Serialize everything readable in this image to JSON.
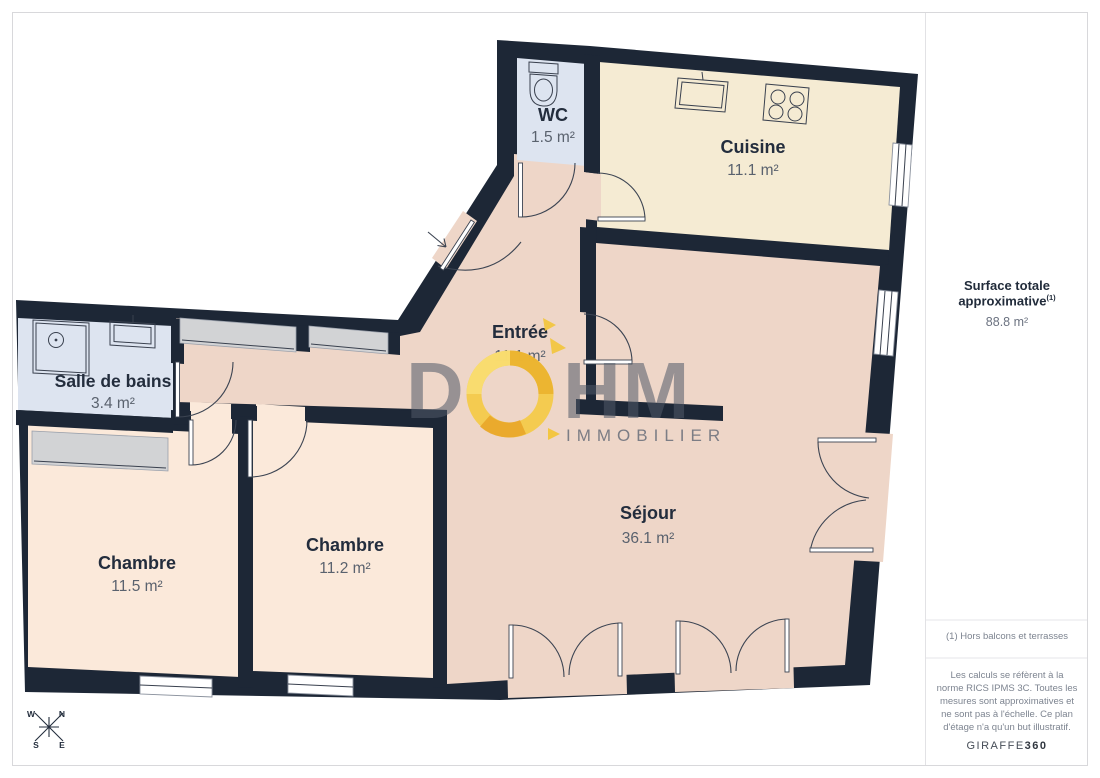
{
  "plan": {
    "rooms": [
      {
        "id": "wc",
        "name": "WC",
        "area": "1.5 m²"
      },
      {
        "id": "cuisine",
        "name": "Cuisine",
        "area": "11.1 m²"
      },
      {
        "id": "entree",
        "name": "Entrée",
        "area": "11.1 m²"
      },
      {
        "id": "salle-de-bains",
        "name": "Salle de bains",
        "area": "3.4 m²"
      },
      {
        "id": "chambre-1",
        "name": "Chambre",
        "area": "11.5 m²"
      },
      {
        "id": "chambre-2",
        "name": "Chambre",
        "area": "11.2 m²"
      },
      {
        "id": "sejour",
        "name": "Séjour",
        "area": "36.1 m²"
      }
    ],
    "compass": {
      "n": "N",
      "e": "E",
      "s": "S",
      "w": "W"
    }
  },
  "watermark": {
    "d": "D",
    "hm": "HM",
    "tagline": "IMMOBILIER"
  },
  "sidebar": {
    "surface_label": "Surface totale approximative",
    "surface_footnote_ref": "(1)",
    "surface_value": "88.8 m²",
    "footnote": "(1) Hors balcons et terrasses",
    "disclaimer": "Les calculs se réfèrent à la norme RICS IPMS 3C. Toutes les mesures sont approximatives et ne sont pas à l'échelle. Ce plan d'étage n'a qu'un but illustratif.",
    "brand": "GIRAFFE",
    "brand_bold": "360"
  },
  "colors": {
    "wall": "#1d2736",
    "living": "#eed6c8",
    "kitchen": "#f5ebd3",
    "bedroom": "#fbe9da",
    "wet_room": "#dde4f0",
    "closet": "#d2d3d5",
    "accent_yellow": "#f3c93e"
  }
}
